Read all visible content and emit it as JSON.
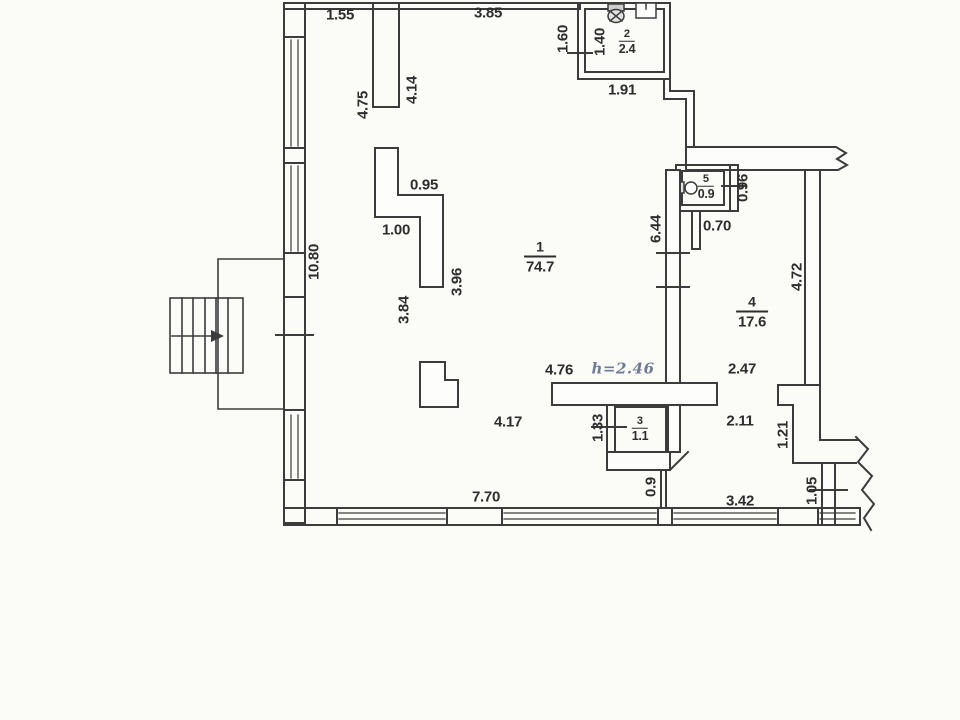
{
  "title": "apartment-floor-plan",
  "colors": {
    "background": "#fbfbf8",
    "line": "#3c3c3c",
    "text": "#2d2d2d",
    "handwriting": "#6e7b96"
  },
  "rooms": {
    "r1": {
      "number": "1",
      "area": "74.7"
    },
    "r2": {
      "number": "2",
      "area": "2.4"
    },
    "r3": {
      "number": "3",
      "area": "1.1"
    },
    "r4": {
      "number": "4",
      "area": "17.6"
    },
    "r5": {
      "number": "5",
      "area": "0.9"
    }
  },
  "dims": {
    "top_left": "1.55",
    "top": "3.85",
    "room2_outer": "1.60",
    "room2_inner": "1.40",
    "room2_bottom": "1.91",
    "stub_left": "4.75",
    "stub_right": "4.14",
    "z_top": "0.95",
    "z_mid": "1.00",
    "z_right": "3.96",
    "z_left": "3.84",
    "left_wall": "10.80",
    "mid_wall": "6.44",
    "room5_h": "0.96",
    "room5_door": "0.70",
    "room4_right": "4.72",
    "room4_upper": "2.47",
    "room4_lower": "2.11",
    "room4_niche": "1.21",
    "hall_top": "4.76",
    "height_note": "h=2.46",
    "hall_bottom": "4.17",
    "room3_h": "1.33",
    "bottom_pass": "0.9",
    "bottom_left": "7.70",
    "bottom_right": "3.42",
    "bottom_niche": "1.05"
  },
  "icons": {
    "room2_toilet": "toilet-icon",
    "room2_appliance": "water-heater-icon",
    "room5_sink": "sink-icon",
    "stairs_arrow": "stairs-direction-arrow"
  }
}
